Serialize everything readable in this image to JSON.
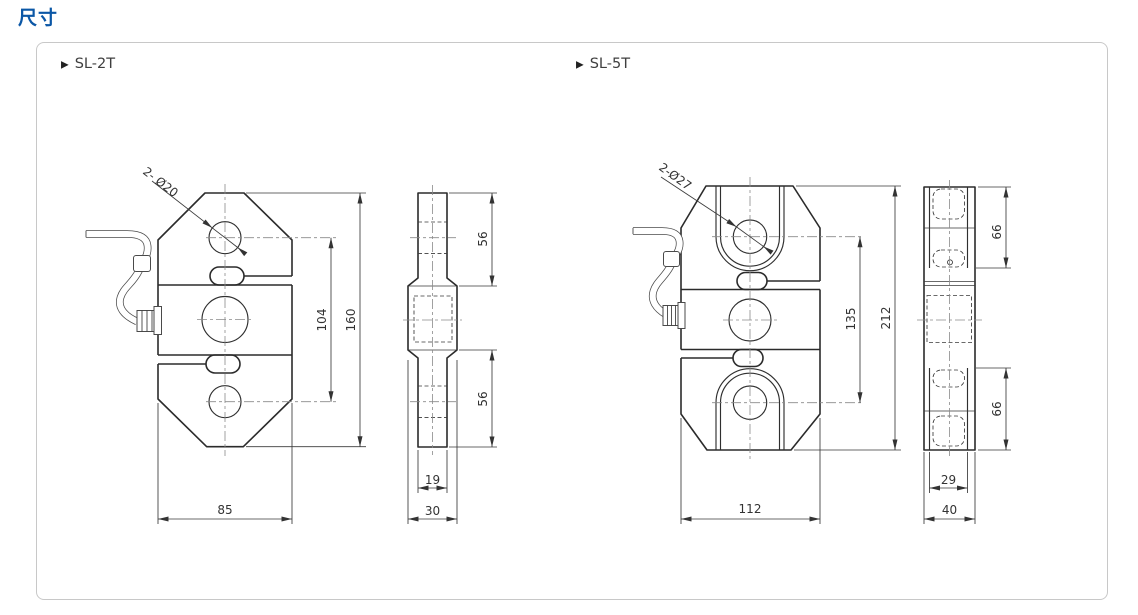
{
  "page": {
    "title": "尺寸"
  },
  "panel": {
    "drawings": [
      {
        "marker": "▶",
        "label": "SL-2T",
        "dims": {
          "hole": "2- Ø20",
          "inner_height": "104",
          "overall_height": "160",
          "width": "85",
          "upper_end": "56",
          "lower_end": "56",
          "end_width": "19",
          "thickness": "30"
        }
      },
      {
        "marker": "▶",
        "label": "SL-5T",
        "dims": {
          "hole": "2-Ø27",
          "inner_height": "135",
          "overall_height": "212",
          "width": "112",
          "upper_end": "66",
          "lower_end": "66",
          "end_width": "29",
          "thickness": "40"
        }
      }
    ]
  }
}
